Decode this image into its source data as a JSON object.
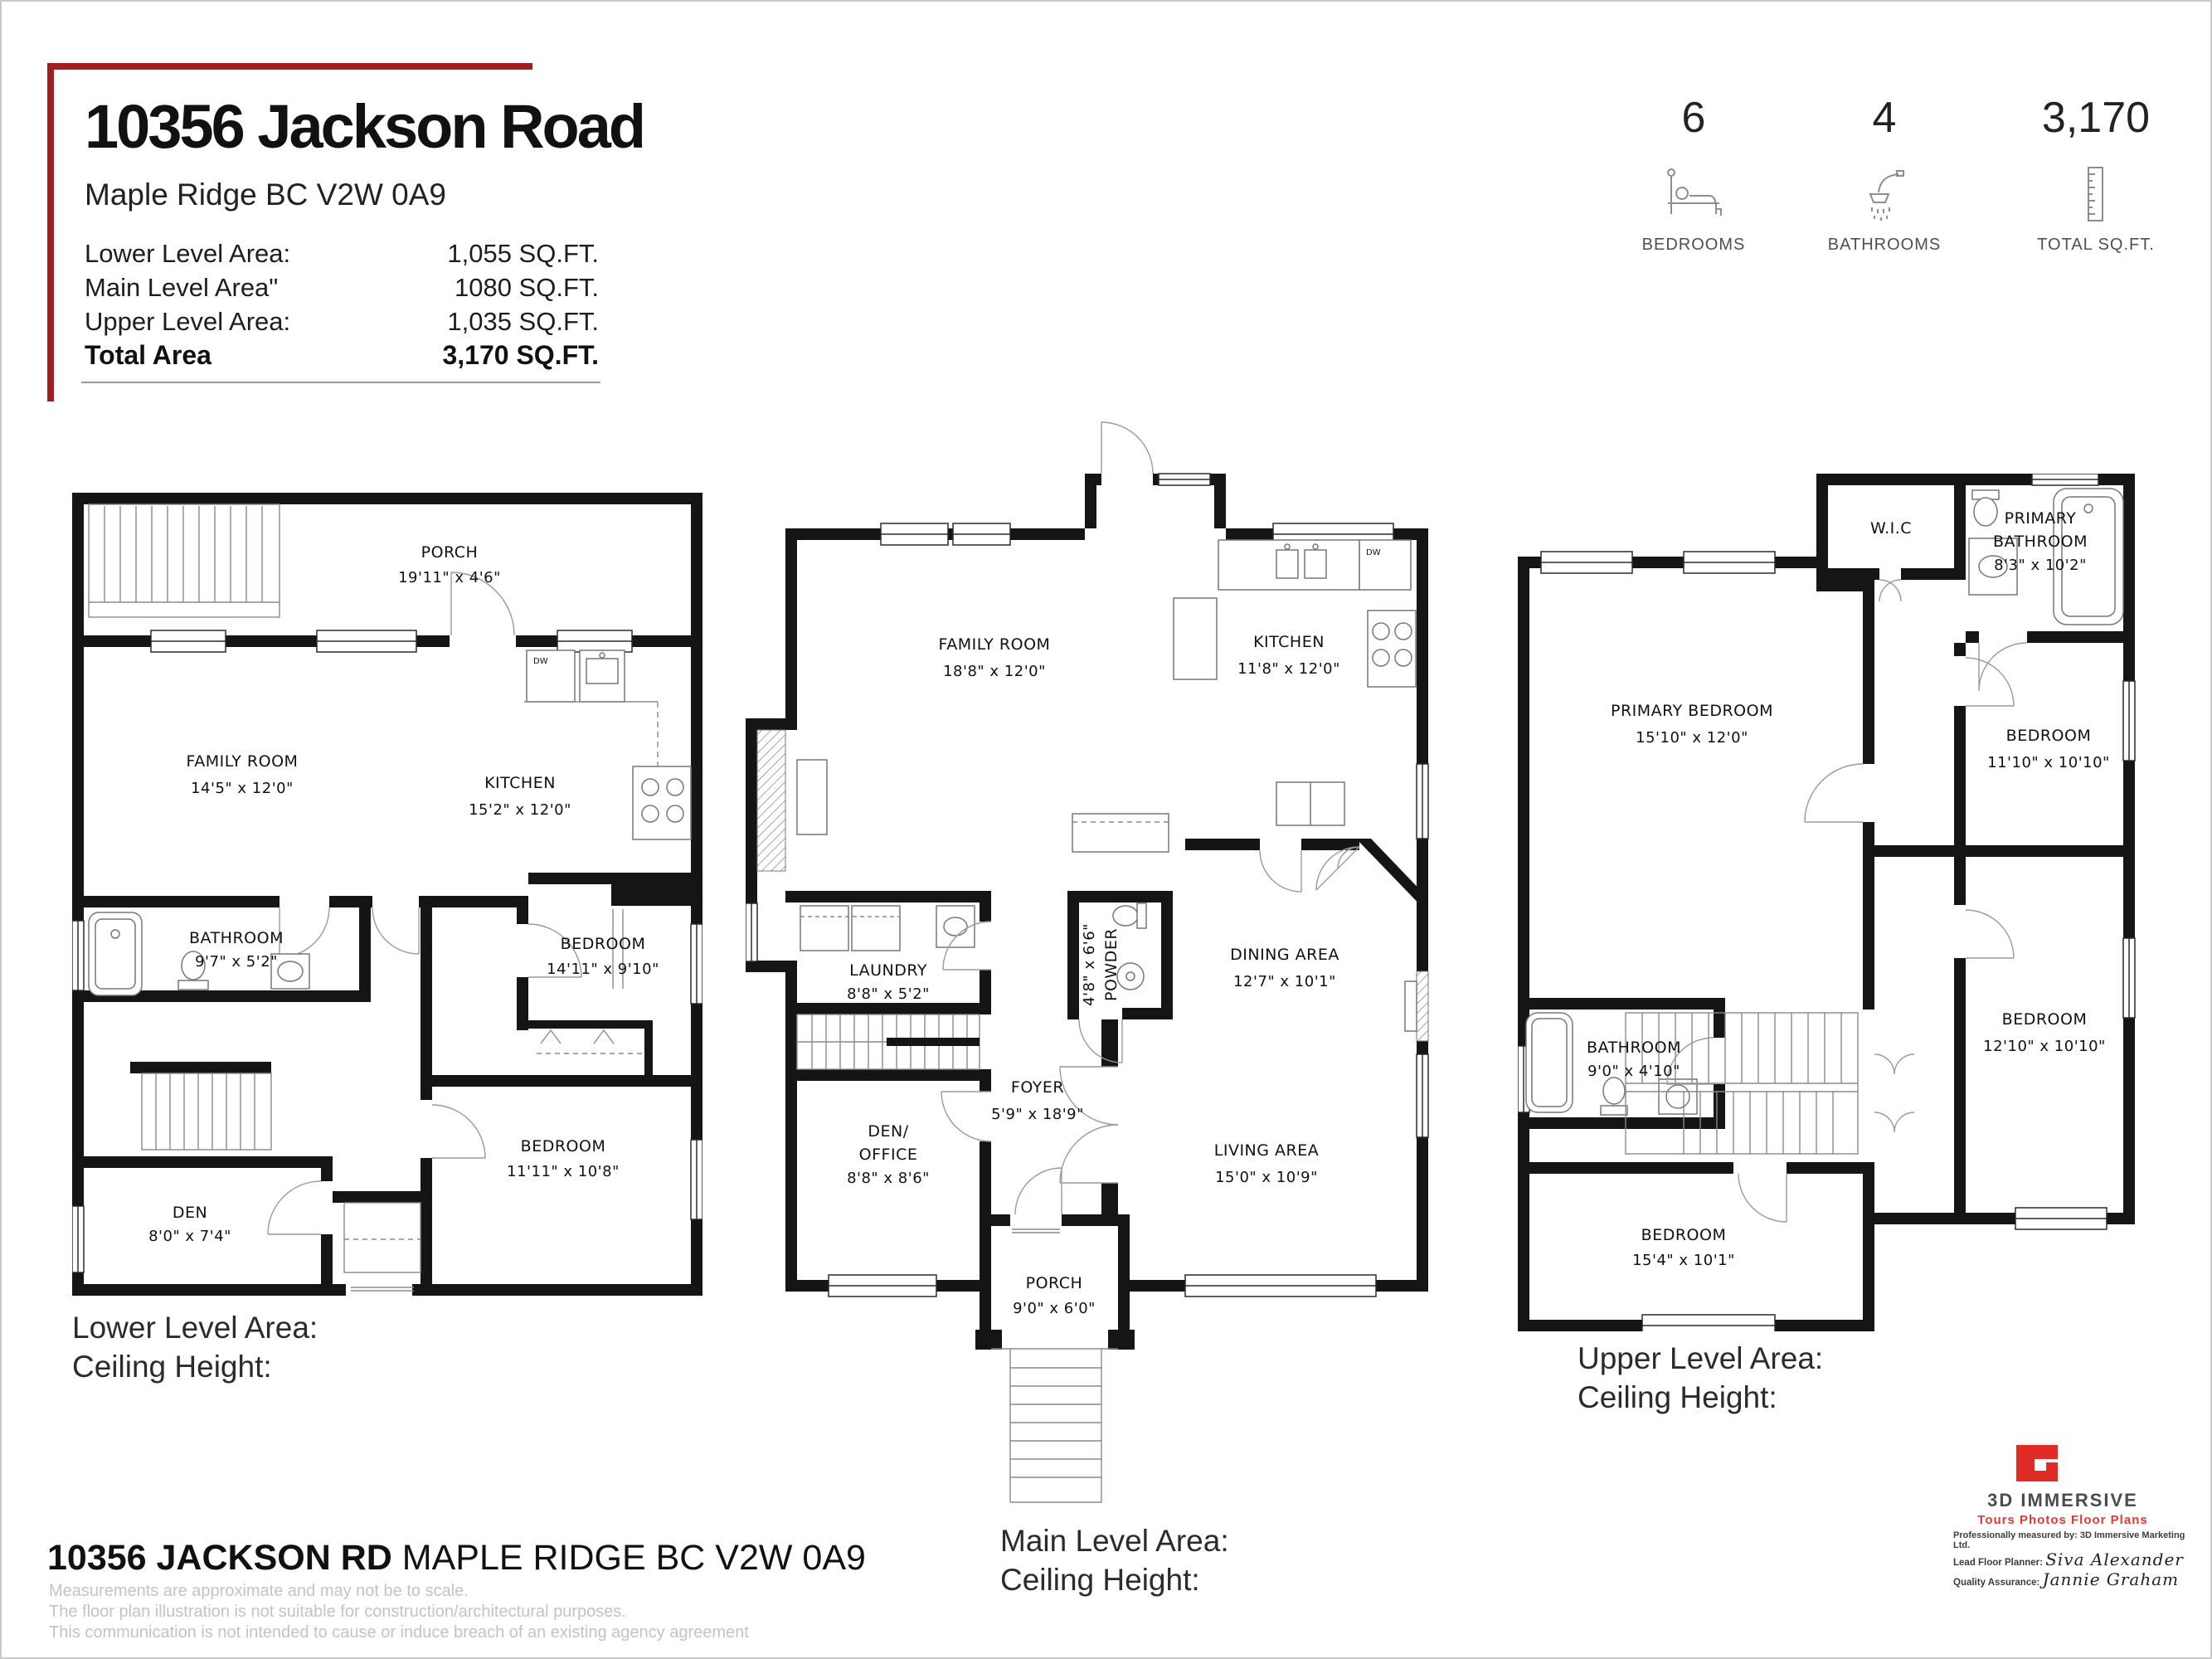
{
  "header": {
    "address": "10356 Jackson Road",
    "city_line": "Maple Ridge BC V2W 0A9",
    "areas": [
      {
        "label": "Lower Level Area:",
        "value": "1,055 SQ.FT."
      },
      {
        "label": "Main Level Area\"",
        "value": "1080 SQ.FT."
      },
      {
        "label": "Upper Level Area:",
        "value": "1,035 SQ.FT."
      }
    ],
    "total_label": "Total Area",
    "total_value": "3,170 SQ.FT."
  },
  "stats": {
    "bedrooms": {
      "value": "6",
      "label": "BEDROOMS"
    },
    "bathrooms": {
      "value": "4",
      "label": "BATHROOMS"
    },
    "sqft": {
      "value": "3,170",
      "label": "TOTAL SQ.FT."
    }
  },
  "plans": {
    "lower": {
      "caption_line1": "Lower Level Area:",
      "caption_line2": "Ceiling Height:",
      "fixture_labels": {
        "dw": "DW"
      },
      "rooms": {
        "porch": {
          "name": "PORCH",
          "dims": "19'11\" x 4'6\""
        },
        "family": {
          "name": "FAMILY ROOM",
          "dims": "14'5\" x 12'0\""
        },
        "kitchen": {
          "name": "KITCHEN",
          "dims": "15'2\" x 12'0\""
        },
        "bathroom": {
          "name": "BATHROOM",
          "dims": "9'7\" x 5'2\""
        },
        "bedroom1": {
          "name": "BEDROOM",
          "dims": "14'11\" x 9'10\""
        },
        "bedroom2": {
          "name": "BEDROOM",
          "dims": "11'11\" x 10'8\""
        },
        "den": {
          "name": "DEN",
          "dims": "8'0\" x 7'4\""
        }
      }
    },
    "main": {
      "caption_line1": "Main Level Area:",
      "caption_line2": "Ceiling Height:",
      "fixture_labels": {
        "dw": "DW"
      },
      "rooms": {
        "family": {
          "name": "FAMILY ROOM",
          "dims": "18'8\" x 12'0\""
        },
        "kitchen": {
          "name": "KITCHEN",
          "dims": "11'8\" x 12'0\""
        },
        "laundry": {
          "name": "LAUNDRY",
          "dims": "8'8\" x 5'2\""
        },
        "powder": {
          "name": "POWDER",
          "dims": "4'8\" x 6'6\""
        },
        "dining": {
          "name": "DINING AREA",
          "dims": "12'7\" x 10'1\""
        },
        "foyer": {
          "name": "FOYER",
          "dims": "5'9\" x 18'9\""
        },
        "den_office_1": "DEN/",
        "den_office_2": "OFFICE",
        "den_office_dims": "8'8\" x 8'6\"",
        "living": {
          "name": "LIVING AREA",
          "dims": "15'0\" x 10'9\""
        },
        "porch": {
          "name": "PORCH",
          "dims": "9'0\" x 6'0\""
        }
      }
    },
    "upper": {
      "caption_line1": "Upper Level Area:",
      "caption_line2": "Ceiling Height:",
      "rooms": {
        "wic": {
          "name": "W.I.C"
        },
        "primary_bath_1": "PRIMARY",
        "primary_bath_2": "BATHROOM",
        "primary_bath_dims": "8'3\" x 10'2\"",
        "primary_bedroom": {
          "name": "PRIMARY BEDROOM",
          "dims": "15'10\" x 12'0\""
        },
        "bedroom1": {
          "name": "BEDROOM",
          "dims": "11'10\" x 10'10\""
        },
        "bathroom": {
          "name": "BATHROOM",
          "dims": "9'0\" x 4'10\""
        },
        "bedroom2": {
          "name": "BEDROOM",
          "dims": "12'10\" x 10'10\""
        },
        "bedroom3": {
          "name": "BEDROOM",
          "dims": "15'4\" x 10'1\""
        }
      }
    }
  },
  "footer": {
    "address_bold": "10356 JACKSON RD",
    "address_light": " MAPLE RIDGE BC V2W 0A9",
    "disclaimers": [
      "Measurements are approximate and may not be to scale.",
      "The floor plan illustration is not suitable for construction/architectural purposes.",
      "This communication is not intended to cause or induce breach of an existing agency agreement"
    ]
  },
  "branding": {
    "logo_title": "3D IMMERSIVE",
    "logo_subtitle": "Tours  Photos  Floor Plans",
    "measured_by": "Professionally measured by: 3D Immersive Marketing Ltd.",
    "planner_label": "Lead Floor Planner:",
    "planner_name": "Siva Alexander",
    "qa_label": "Quality Assurance:",
    "qa_name": "Jannie Graham"
  }
}
